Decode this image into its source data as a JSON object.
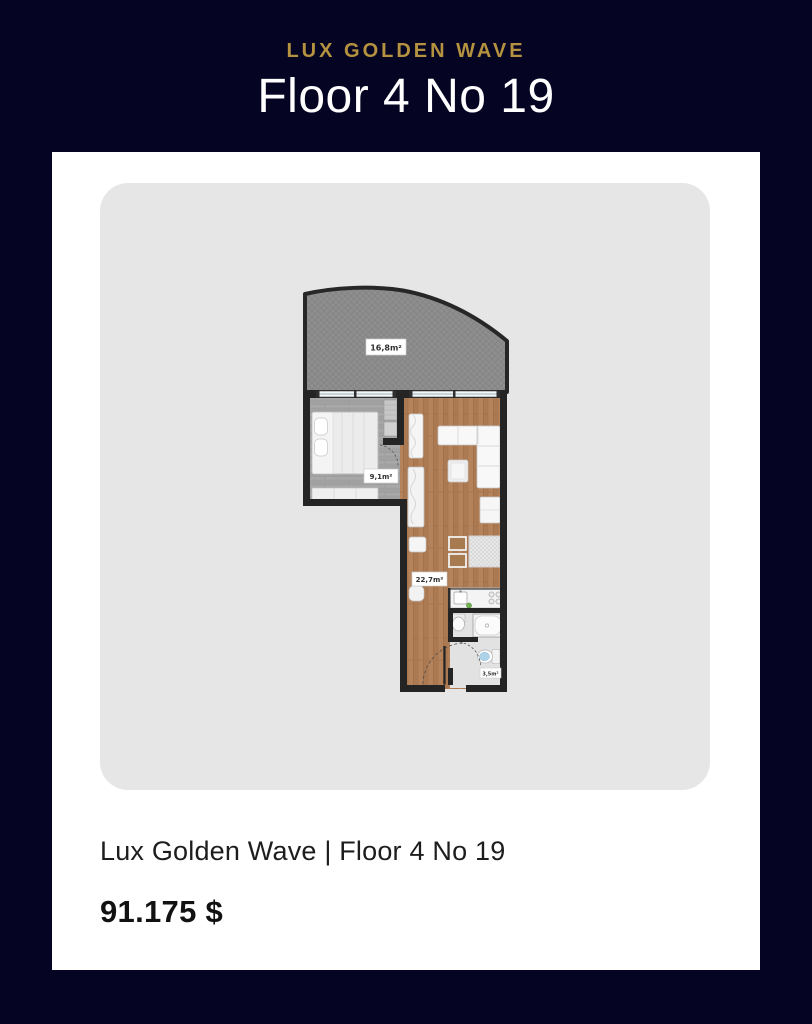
{
  "header": {
    "brand": "LUX GOLDEN WAVE",
    "title": "Floor 4 No 19"
  },
  "card": {
    "caption": "Lux Golden Wave | Floor 4 No 19",
    "price": "91.175 $"
  },
  "floorplan": {
    "rooms": [
      {
        "id": "terrace",
        "label": "16,8m²"
      },
      {
        "id": "bedroom",
        "label": "9,1m²"
      },
      {
        "id": "living-kitchen",
        "label": "22,7m²"
      },
      {
        "id": "bathroom",
        "label": "3,5m²"
      }
    ]
  },
  "colors": {
    "background_navy": "#050423",
    "accent_gold": "#b5923f",
    "card_white": "#ffffff",
    "panel_gray": "#e6e6e6",
    "wall_dark": "#242424",
    "wood_brown": "#b4825b",
    "wood_gray": "#a8a8a8",
    "terrace_gray": "#8e8e8e"
  }
}
